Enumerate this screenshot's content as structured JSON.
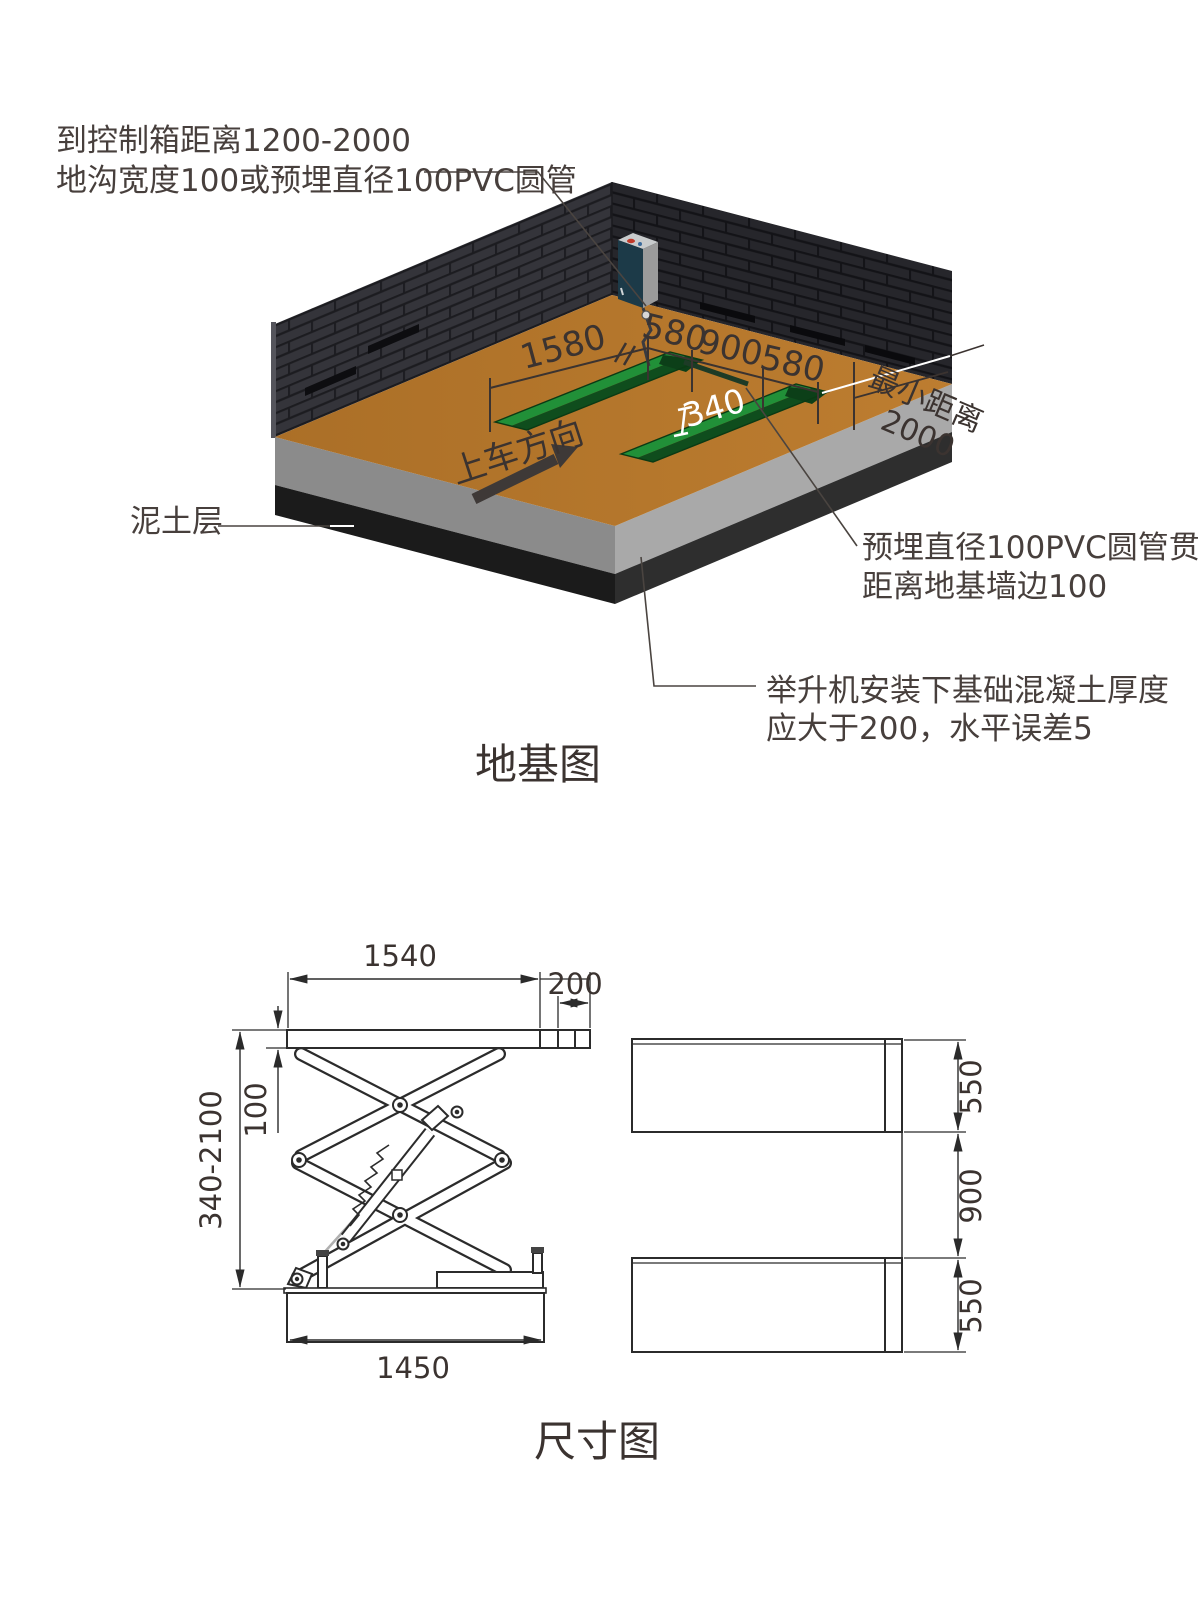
{
  "foundation_diagram": {
    "title": "地基图",
    "annotations": {
      "control_box_line1": "到控制箱距离1200-2000",
      "control_box_line2": "地沟宽度100或预埋直径100PVC圆管",
      "soil_layer": "泥土层",
      "pvc_line1": "预埋直径100PVC圆管贯通",
      "pvc_line2": "距离地基墙边100",
      "concrete_line1": "举升机安装下基础混凝土厚度",
      "concrete_line2": "应大于200，水平误差5",
      "min_distance_line1": "最小距离",
      "min_distance_line2": "2000",
      "drive_direction": "上车方向"
    },
    "dimensions": {
      "pit_length": "1580",
      "pit1_width": "580",
      "pit_gap": "900",
      "pit2_width": "580",
      "pit_depth": "340"
    }
  },
  "dimension_diagram": {
    "title": "尺寸图",
    "side_view": {
      "platform_length": "1540",
      "extension_length": "200",
      "platform_thickness": "100",
      "lift_height_range": "340-2100",
      "base_length": "1450"
    },
    "top_view": {
      "platform1_width": "550",
      "platform_gap": "900",
      "platform2_width": "550"
    }
  },
  "colors": {
    "floor_brown": "#b5772c",
    "wall_dark": "#2c2c32",
    "pit_green_light": "#219038",
    "pit_green_dark": "#0f4d1d",
    "concrete_gray": "#a9a9a9",
    "soil_black": "#1e1e1e",
    "control_box_blue": "#1c3a48",
    "line_dark": "#2b2b2b",
    "annotation_text": "#473f3c"
  }
}
